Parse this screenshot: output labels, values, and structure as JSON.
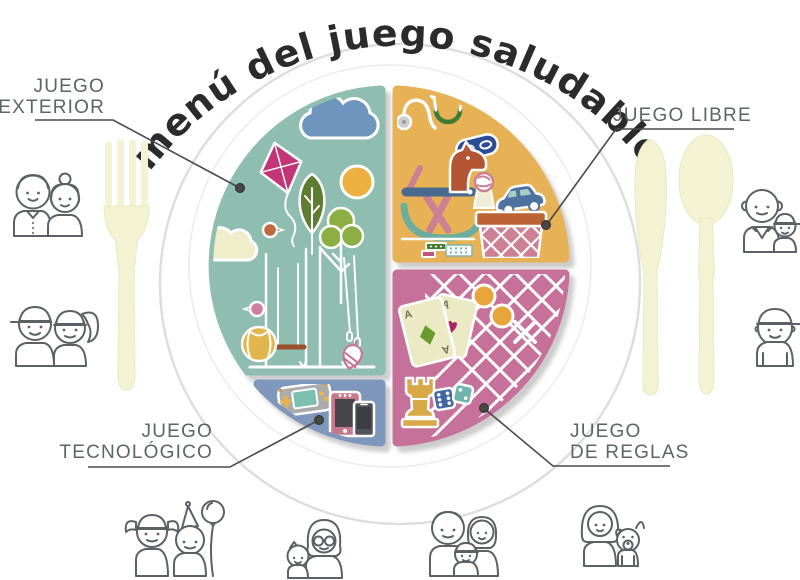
{
  "title": "menú del juego saludable",
  "plate": {
    "sections": [
      {
        "id": "juego-exterior",
        "label_line1": "JUEGO",
        "label_line2": "EXTERIOR",
        "color": "#8FBDB0",
        "icons": [
          "cloud-icon",
          "kite-icon",
          "sun-icon",
          "tree-dark-icon",
          "tree-light-icon",
          "bird-orange-icon",
          "bird-pink-icon",
          "swing-set-icon",
          "beach-ball-icon",
          "spinning-top-icon",
          "cream-cloud-icon"
        ]
      },
      {
        "id": "juego-libre",
        "label_line1": "JUEGO LIBRE",
        "label_line2": "",
        "color": "#E6B254",
        "icons": [
          "stethoscope-icon",
          "superhero-mask-icon",
          "rocking-horse-icon",
          "rattle-icon",
          "toy-car-icon",
          "toy-basket-icon",
          "building-blocks-icon"
        ]
      },
      {
        "id": "juego-de-reglas",
        "label_line1": "JUEGO",
        "label_line2": "DE REGLAS",
        "color": "#C6719A",
        "icons": [
          "playing-cards-icon",
          "tic-tac-toe-icon",
          "chess-rook-icon",
          "dice-icon"
        ]
      },
      {
        "id": "juego-tecnologico",
        "label_line1": "JUEGO",
        "label_line2": "TECNOLÓGICO",
        "color": "#7E97BB",
        "icons": [
          "game-console-icon",
          "tablet-icon",
          "smartphone-icon"
        ]
      }
    ]
  },
  "card_letter": "A",
  "cutlery": {
    "left": "fork",
    "right": [
      "knife",
      "spoon"
    ],
    "color": "#F3F2D2"
  },
  "people_icons": [
    "couple-adults",
    "kids-pair",
    "grandfather-with-child",
    "boy-with-cap",
    "girl-and-boy-with-balloon",
    "grandmother-with-child",
    "family-of-three",
    "woman-with-dog"
  ],
  "colors": {
    "title": "#2B2B2B",
    "label_text": "#5E6366",
    "leader_line": "#4A4A4A",
    "plate_rim": "#DEDEDE",
    "people_outline": "#5C6165",
    "teal": "#8FBDB0",
    "yellow": "#E6B254",
    "pink": "#C6719A",
    "blue": "#7E97BB"
  }
}
